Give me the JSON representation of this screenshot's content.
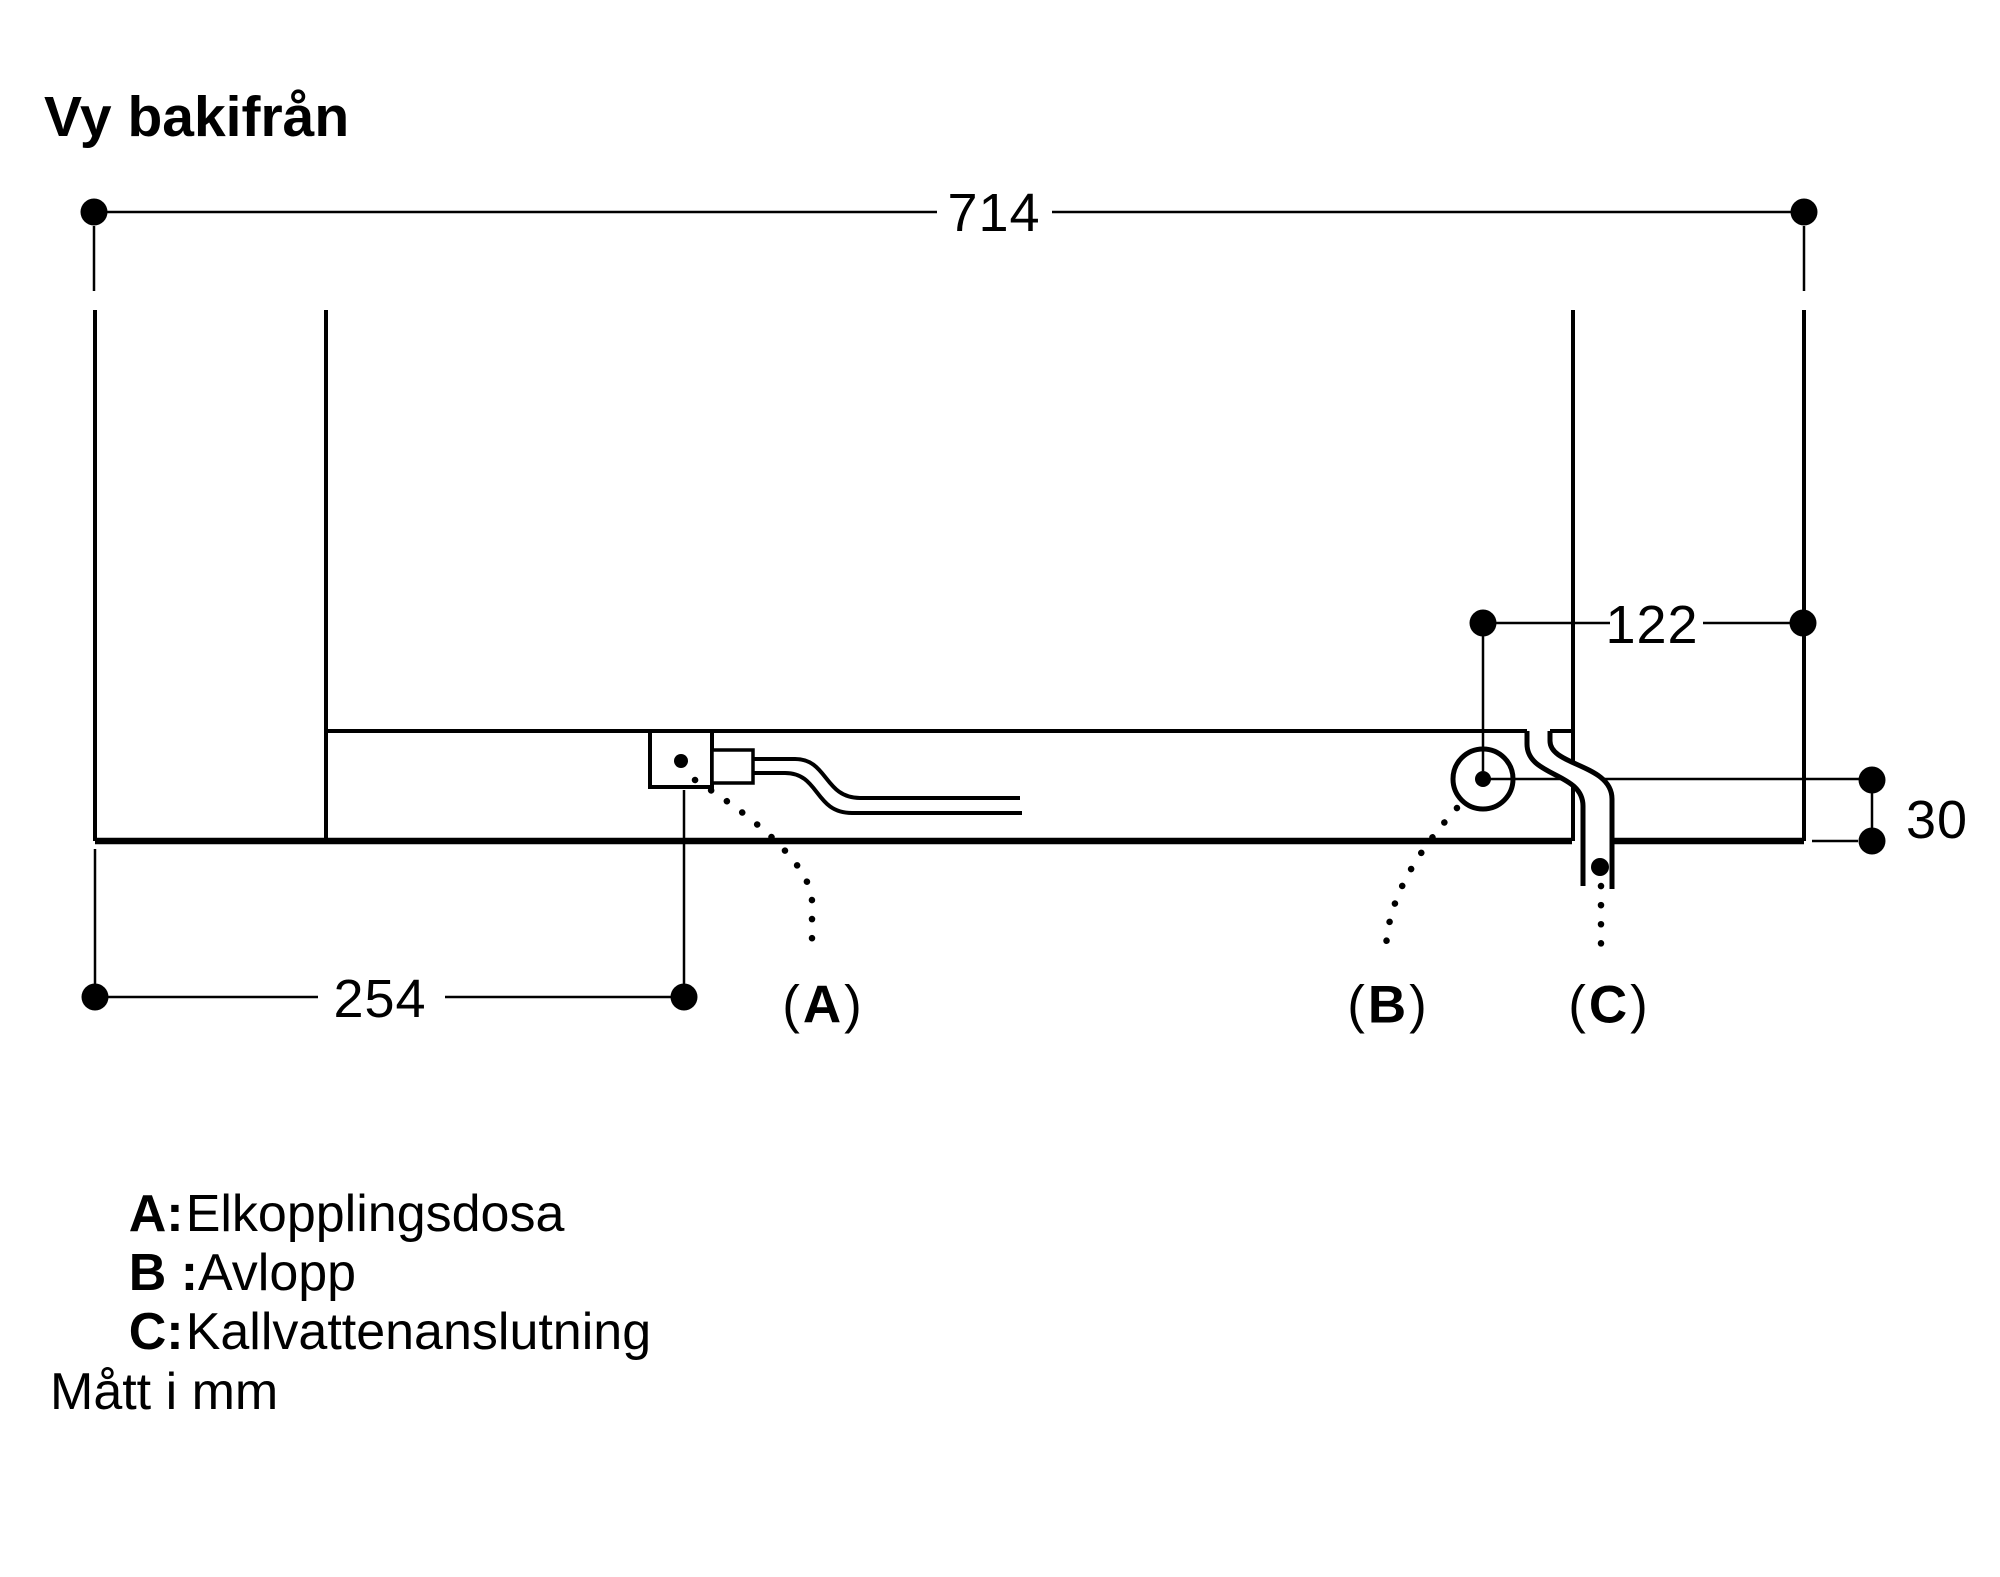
{
  "page": {
    "title": "Vy bakifrån",
    "units_note": "Mått i mm"
  },
  "diagram": {
    "view": "rear-view-installation-drawing",
    "dimensions": {
      "total_width": "714",
      "drain_to_right_edge": "122",
      "drain_to_bottom": "30",
      "left_to_junction_box": "254"
    },
    "callouts": {
      "a": {
        "open": "(",
        "letter": "A",
        "close": ")"
      },
      "b": {
        "open": "(",
        "letter": "B",
        "close": ")"
      },
      "c": {
        "open": "(",
        "letter": "C",
        "close": ")"
      }
    }
  },
  "legend": {
    "items": [
      {
        "key": "A:",
        "label": "Elkopplingsdosa"
      },
      {
        "key": "B :",
        "label": "Avlopp"
      },
      {
        "key": "C:",
        "label": "Kallvattenanslutning"
      }
    ]
  },
  "colors": {
    "ink": "#000000",
    "paper": "#ffffff"
  }
}
